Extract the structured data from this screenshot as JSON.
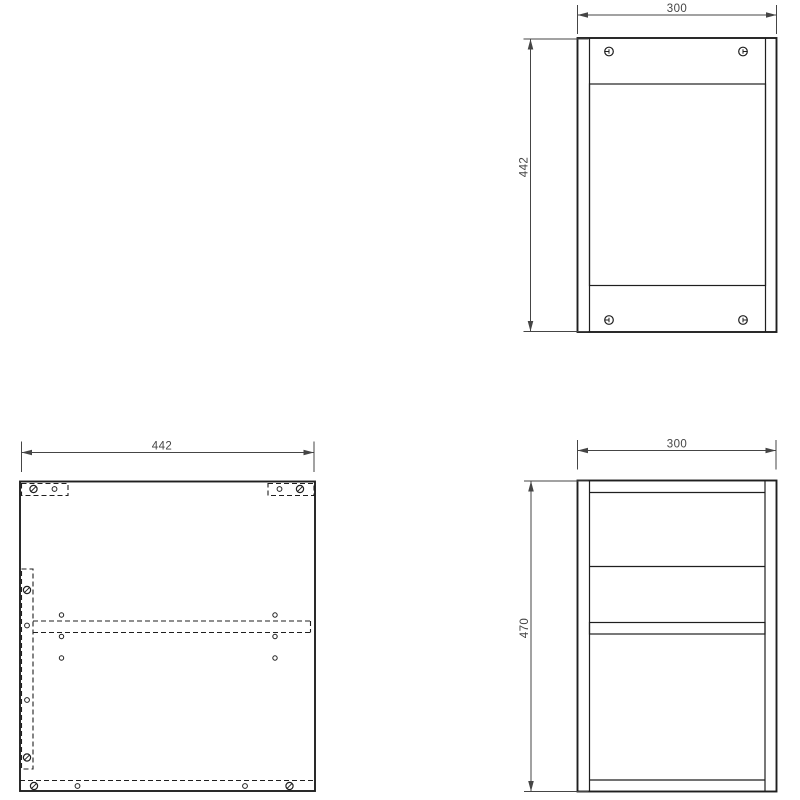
{
  "drawing": {
    "background": "#ffffff",
    "line_color": "#1f1f1f",
    "dim_color": "#454545",
    "dimensions": {
      "front_width": "300",
      "front_height": "442",
      "panel_width": "442",
      "side_width": "300",
      "side_height": "470"
    }
  }
}
